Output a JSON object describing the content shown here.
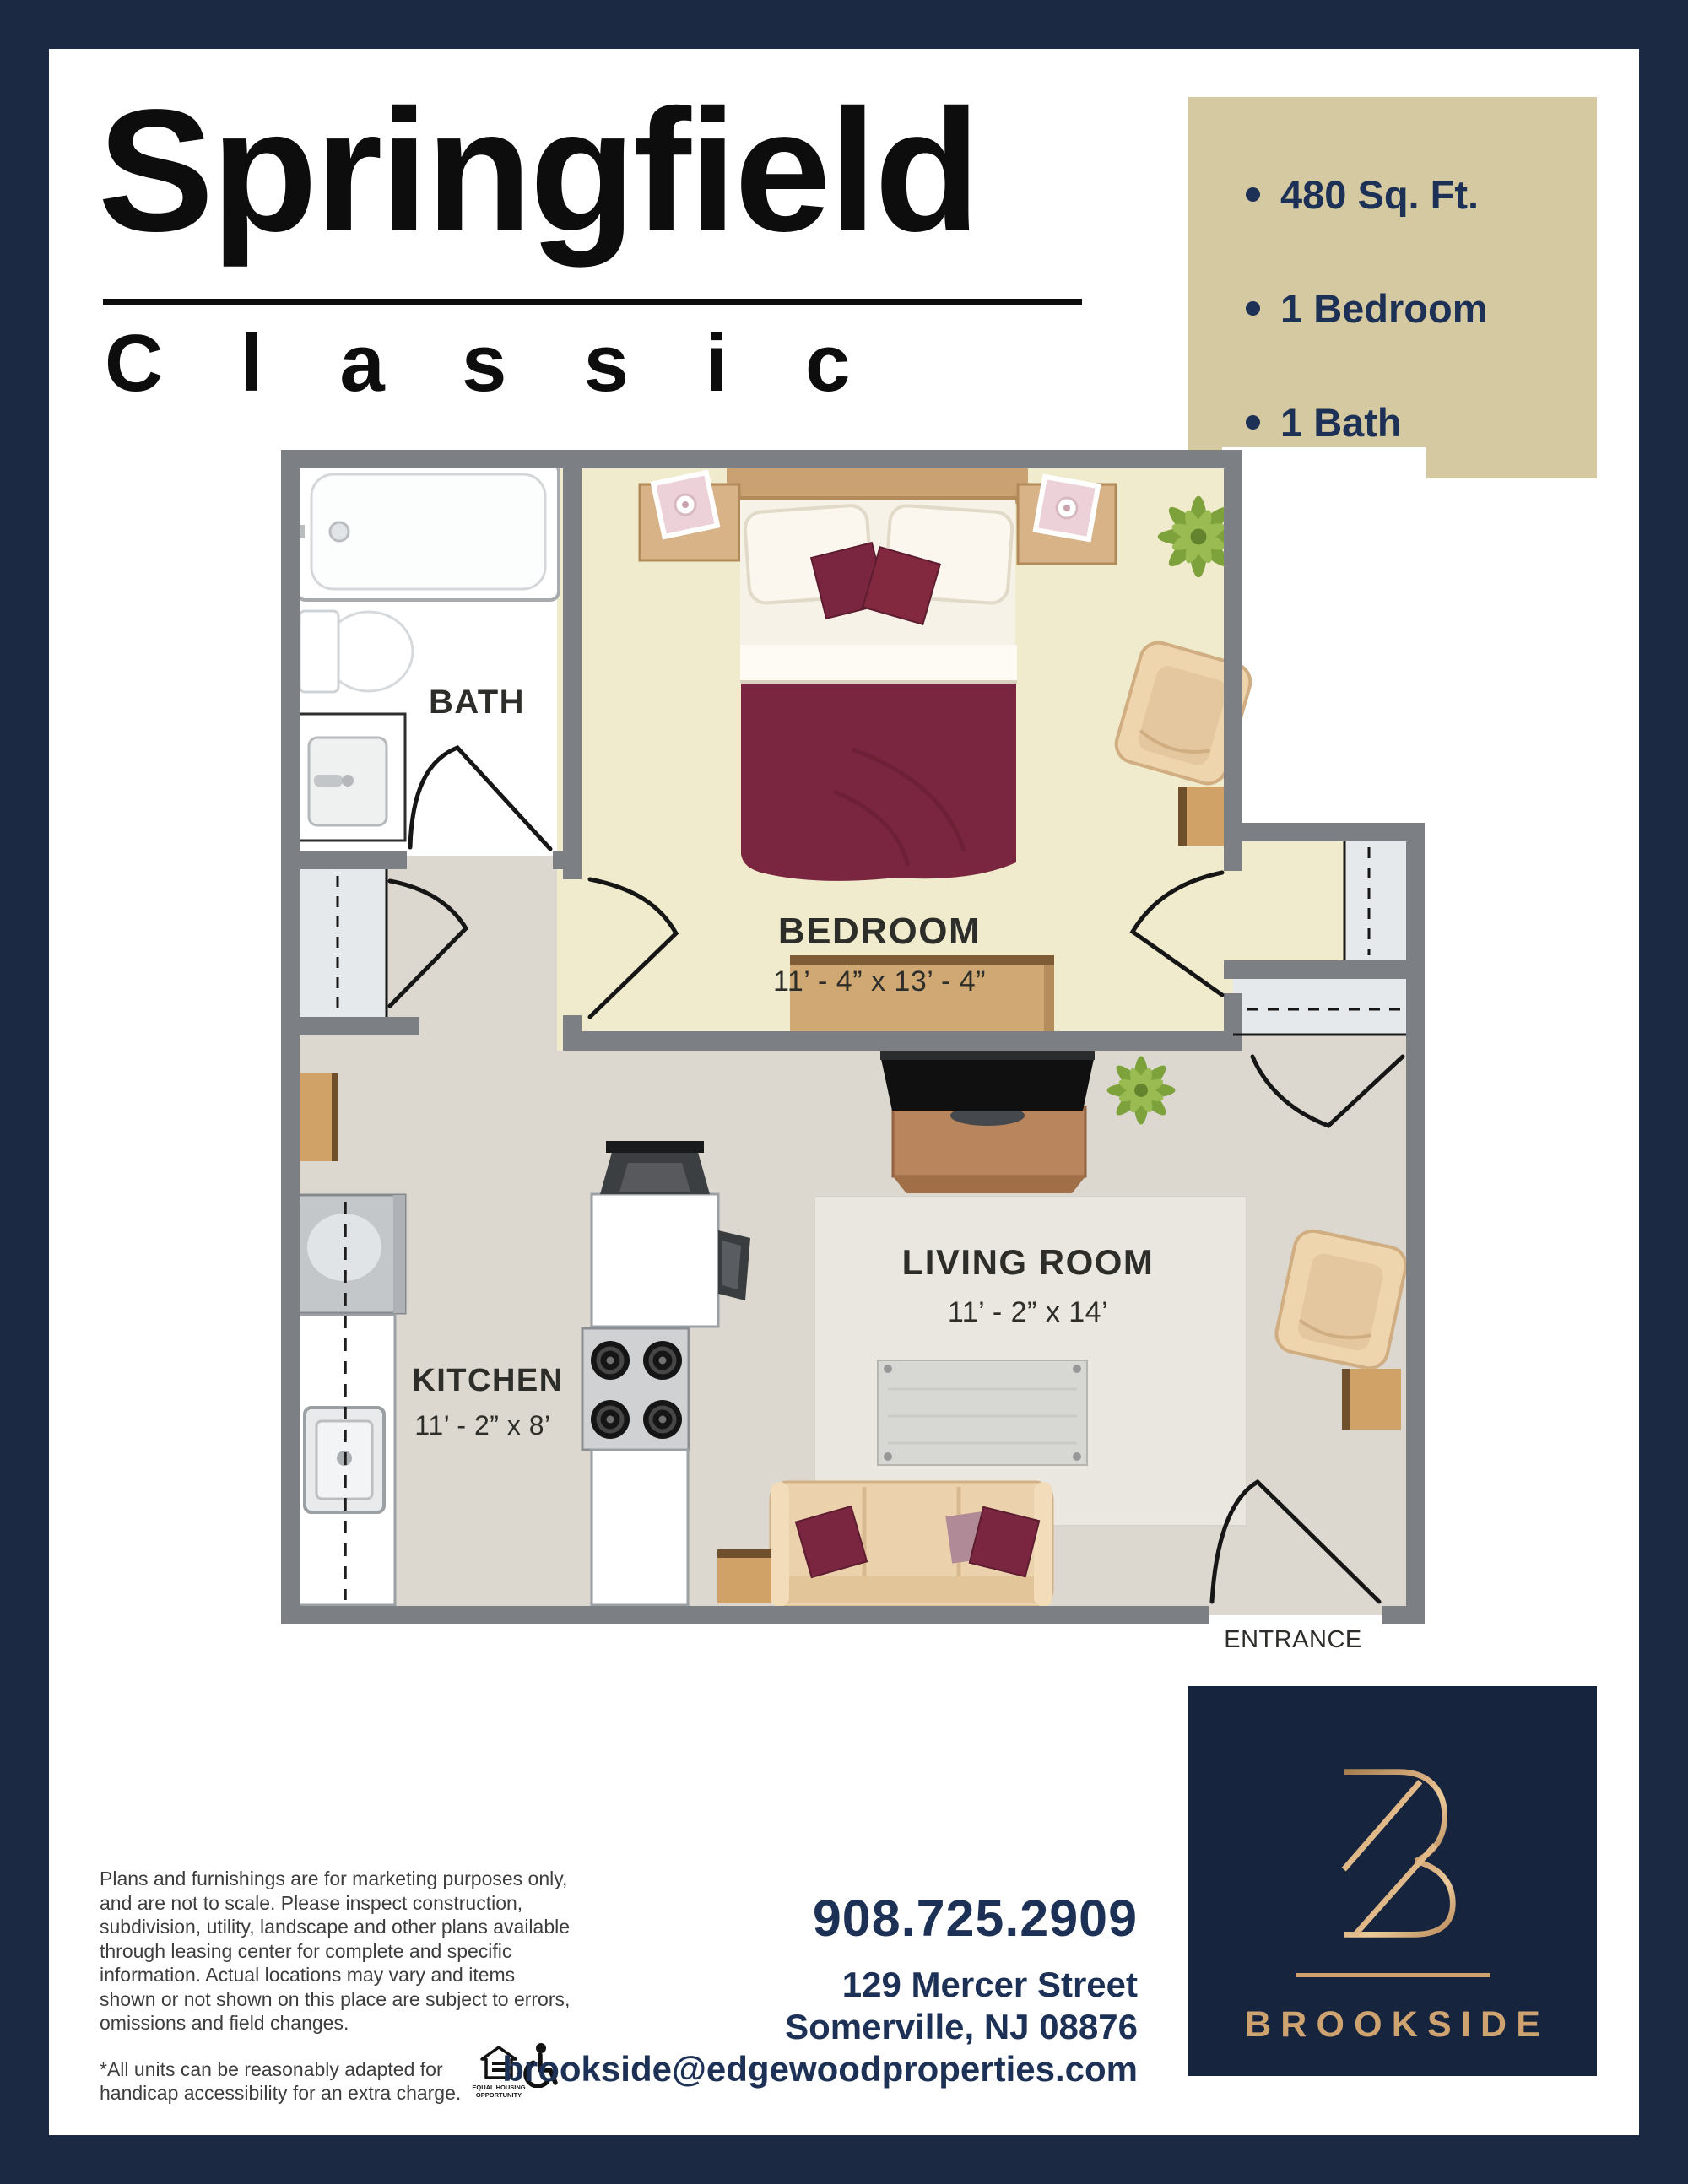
{
  "header": {
    "title": "Springfield",
    "subtitle": "Classic"
  },
  "features": {
    "items": [
      "480 Sq. Ft.",
      "1 Bedroom",
      "1 Bath"
    ]
  },
  "floorplan": {
    "bath": {
      "name": "BATH"
    },
    "bedroom": {
      "name": "BEDROOM",
      "dims": "11’ - 4” x 13’ - 4”"
    },
    "living": {
      "name": "LIVING ROOM",
      "dims": "11’ - 2” x 14’"
    },
    "kitchen": {
      "name": "KITCHEN",
      "dims": "11’ - 2” x 8’"
    },
    "entrance_label": "ENTRANCE"
  },
  "disclaimer": {
    "paragraph": "Plans and furnishings are for marketing purposes only, and are not to scale. Please inspect construction, subdivision, utility, landscape and other plans available through leasing center for complete and specific information. Actual locations may vary and items shown or not shown on this place are subject to errors, omissions and field changes.",
    "note": "*All units can be reasonably adapted for handicap accessibility for an extra charge.",
    "eho_caption": "EQUAL HOUSING OPPORTUNITY"
  },
  "contact": {
    "phone": "908.725.2909",
    "address_line1": "129 Mercer Street",
    "address_line2": "Somerville, NJ 08876",
    "email": "brookside@edgewoodproperties.com"
  },
  "brand": {
    "name": "BROOKSIDE",
    "monogram": "B"
  },
  "icons": [
    "equal-housing-icon",
    "wheelchair-accessibility-icon"
  ],
  "colors": {
    "border_navy": "#1b2a42",
    "text_navy": "#1d3156",
    "features_tan": "#d5c9a2",
    "logo_navy": "#16243e",
    "gold": "#cfa36f",
    "wall_gray": "#7c7f83",
    "main_floor": "#dcd8d0",
    "bedroom_floor": "#efebcc",
    "bath_floor": "#ffffff",
    "closet_floor": "#e6e9ec",
    "maroon": "#7b2640",
    "wood_tan": "#d0a268"
  }
}
